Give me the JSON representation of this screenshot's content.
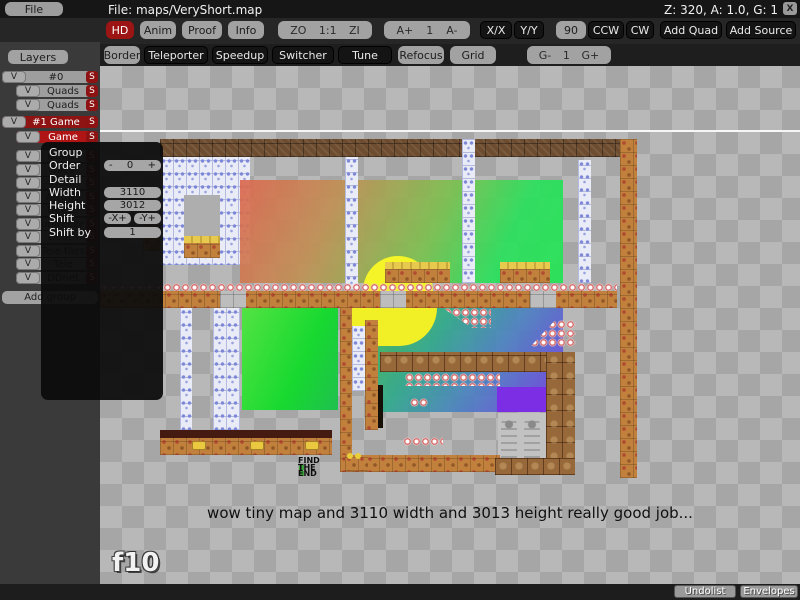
{
  "menubar": {
    "file_label": "File",
    "title": "File: maps/VeryShort.map",
    "status": "Z: 320, A: 1.0, G: 1",
    "close_label": "X"
  },
  "toolbar_top": {
    "hd": "HD",
    "anim": "Anim",
    "proof": "Proof",
    "info": "Info",
    "zoom_out": "ZO",
    "zoom_reset": "1:1",
    "zoom_in": "ZI",
    "anim_faster": "A+",
    "anim_value": "1",
    "anim_slower": "A-",
    "flip_x": "X/X",
    "flip_y": "Y/Y",
    "rotate_amount": "90",
    "ccw": "CCW",
    "cw": "CW",
    "add_quad": "Add Quad",
    "add_source": "Add Source"
  },
  "toolbar_tiles": {
    "border": "Border",
    "teleporter": "Teleporter",
    "speedup": "Speedup",
    "switcher": "Switcher",
    "tune": "Tune",
    "refocus": "Refocus",
    "grid": "Grid",
    "grid_minus": "G-",
    "grid_value": "1",
    "grid_plus": "G+"
  },
  "layers_panel": {
    "header": "Layers",
    "visible_label": "V",
    "solo_label": "S",
    "add_group": "Add group",
    "rows": [
      {
        "label": "#0"
      },
      {
        "label": "Quads"
      },
      {
        "label": "Quads"
      },
      {
        "label": "#1 Game"
      },
      {
        "label": "Game"
      },
      {
        "label": "Quads"
      },
      {
        "label": "Tiles"
      },
      {
        "label": "Front"
      },
      {
        "label": "Arrows"
      },
      {
        "label": "freeze"
      },
      {
        "label": "unfreeze"
      },
      {
        "label": "Death"
      },
      {
        "label": "Tele tiles"
      },
      {
        "label": "Tele"
      },
      {
        "label": "DDnet"
      }
    ]
  },
  "layer_popup": {
    "group_label": "Group",
    "order_label": "Order",
    "order_minus": "-",
    "order_value": "0",
    "order_plus": "+",
    "detail_label": "Detail",
    "width_label": "Width",
    "width_value": "3110",
    "height_label": "Height",
    "height_value": "3012",
    "shift_label": "Shift",
    "shift_x": "-X+",
    "shift_y": "-Y+",
    "shift_by_label": "Shift by",
    "shift_by_value": "1"
  },
  "map": {
    "caption": "wow tiny map and 3110 width and 3013 height really good job...",
    "watermark": "f10",
    "sign_line1": "FIND",
    "sign_line2": "THE",
    "sign_line3": "END"
  },
  "bottombar": {
    "undolist": "Undolist",
    "envelopes": "Envelopes"
  },
  "colors": {
    "accent_red": "#9c1414",
    "selected_red": "#b01515",
    "group_red": "#8e1313"
  }
}
